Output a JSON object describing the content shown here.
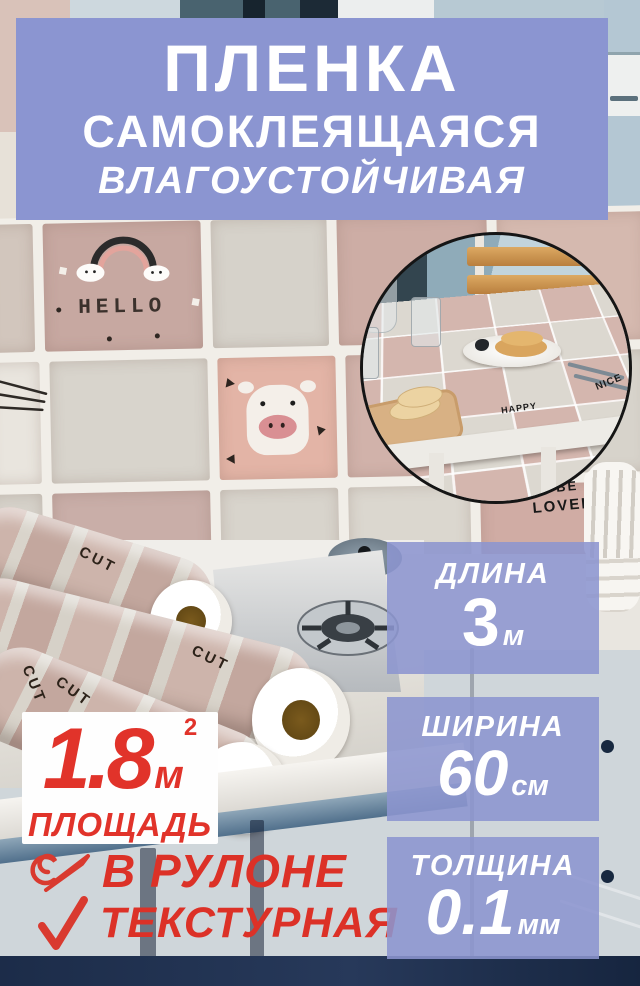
{
  "banner": {
    "title": "ПЛЕНКА",
    "subtitle": "САМОКЛЕЯЩАЯСЯ",
    "tagline": "ВЛАГОУСТОЙЧИВАЯ"
  },
  "area": {
    "value": "1.8",
    "unit": "м",
    "sup": "2",
    "label": "ПЛОЩАДЬ"
  },
  "features": [
    {
      "icon": "roll-icon",
      "label": "В РУЛОНЕ"
    },
    {
      "icon": "checkmark-icon",
      "label": "ТЕКСТУРНАЯ"
    }
  ],
  "specs": [
    {
      "label": "ДЛИНА",
      "value": "3",
      "unit": "м"
    },
    {
      "label": "ШИРИНА",
      "value": "60",
      "unit": "см"
    },
    {
      "label": "ТОЛЩИНА",
      "value": "0.1",
      "unit": "мм"
    }
  ],
  "photo_texts": {
    "hello": "HELLO",
    "be": "BE",
    "lovely": "LOVELY",
    "cut": "CUT",
    "nice": "NICE",
    "happy": "HAPPY",
    "table_be": "BE",
    "table_lovely": "LOVELY"
  },
  "colors": {
    "banner_bg": "#8b95d1",
    "badge_bg": "#8c95cf",
    "accent_red": "#e1332a",
    "cabinet_blue": "#55718f",
    "navy_strip": "#1c2c49",
    "tile_pink": "#c7a8a1",
    "tile_gray": "#d6d2ca"
  }
}
